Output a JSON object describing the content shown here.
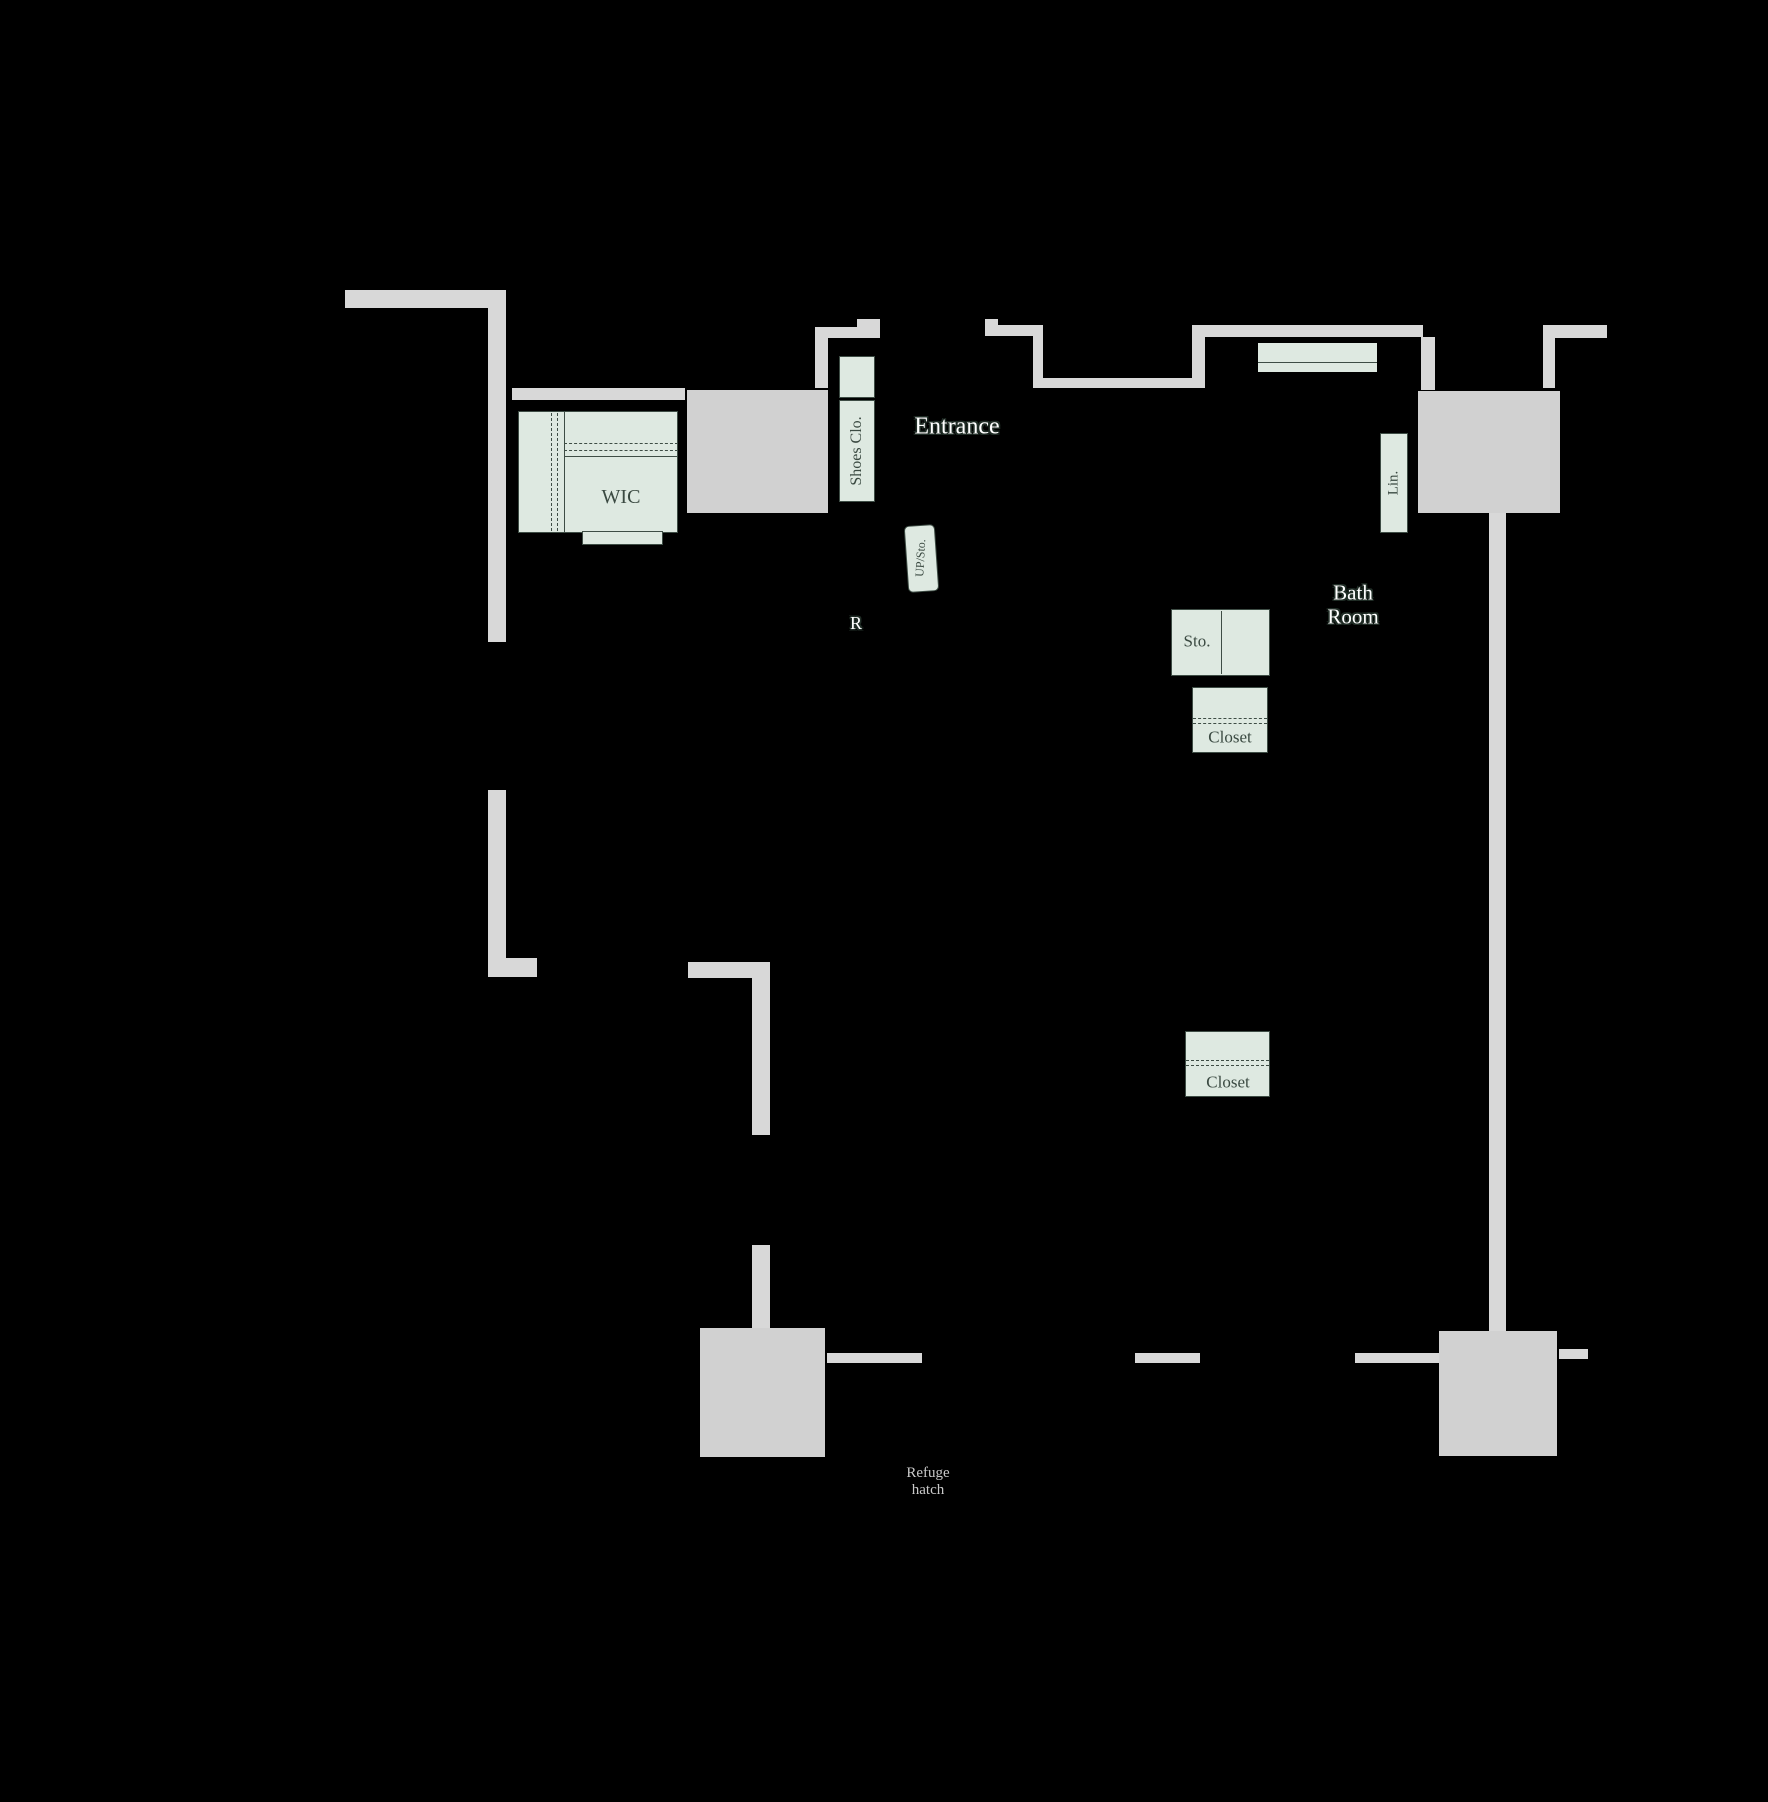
{
  "canvas": {
    "width": 1768,
    "height": 1802,
    "background": "#000000"
  },
  "colors": {
    "background": "#000000",
    "wall": "#d8d8d8",
    "wall_box": "#d1d1d1",
    "fixture_fill": "#dee9e1",
    "fixture_border": "#3e4d45",
    "label_dark": "#3b4a42",
    "label_outline": "#202d26",
    "label_gray": "#c9c9c9"
  },
  "labels": [
    {
      "id": "entrance-label",
      "text": "Entrance",
      "x": 957,
      "y": 427,
      "size": 24,
      "style": "outlined",
      "rot": 0
    },
    {
      "id": "bath-room-label",
      "lines": [
        "Bath",
        "Room"
      ],
      "x": 1353,
      "y": 605,
      "size": 21,
      "style": "outlined",
      "rot": 0
    },
    {
      "id": "r-mark-label",
      "text": "R",
      "x": 856,
      "y": 623,
      "size": 18,
      "style": "outlined",
      "rot": 0
    },
    {
      "id": "wic-label",
      "text": "WIC",
      "x": 621,
      "y": 497,
      "size": 20,
      "style": "dark",
      "rot": 0
    },
    {
      "id": "shoes-closet-label",
      "text": "Shoes Clo.",
      "x": 857,
      "y": 451,
      "size": 16,
      "style": "dark",
      "rot": -90
    },
    {
      "id": "linen-label",
      "text": "Lin.",
      "x": 1394,
      "y": 483,
      "size": 15,
      "style": "dark",
      "rot": -90
    },
    {
      "id": "storage-label",
      "text": "Sto.",
      "x": 1197,
      "y": 641,
      "size": 17,
      "style": "dark",
      "rot": 0
    },
    {
      "id": "closet-1-label",
      "text": "Closet",
      "x": 1230,
      "y": 737,
      "size": 17,
      "style": "dark",
      "rot": 0
    },
    {
      "id": "closet-2-label",
      "text": "Closet",
      "x": 1228,
      "y": 1082,
      "size": 17,
      "style": "dark",
      "rot": 0
    },
    {
      "id": "up-storage-label",
      "text": "UP/Sto.",
      "x": 921,
      "y": 558,
      "size": 12,
      "style": "dark",
      "rot": -87
    },
    {
      "id": "refuge-hatch-label",
      "lines": [
        "Refuge",
        "hatch"
      ],
      "x": 928,
      "y": 1482,
      "size": 15,
      "style": "gray",
      "rot": 0
    }
  ],
  "walls": [
    {
      "id": "wall-top-left-h",
      "x": 345,
      "y": 290,
      "w": 161,
      "h": 18
    },
    {
      "id": "wall-left-upper",
      "x": 488,
      "y": 290,
      "w": 18,
      "h": 352
    },
    {
      "id": "wall-left-lower",
      "x": 488,
      "y": 790,
      "w": 18,
      "h": 172
    },
    {
      "id": "wall-left-foot",
      "x": 488,
      "y": 958,
      "w": 49,
      "h": 19
    },
    {
      "id": "wall-wic-top",
      "x": 512,
      "y": 388,
      "w": 173,
      "h": 12
    },
    {
      "id": "wall-mid-left-h",
      "x": 688,
      "y": 962,
      "w": 82,
      "h": 16
    },
    {
      "id": "wall-mid-left-v",
      "x": 752,
      "y": 978,
      "w": 18,
      "h": 157
    },
    {
      "id": "wall-mid-left-v2",
      "x": 752,
      "y": 1245,
      "w": 18,
      "h": 83
    },
    {
      "id": "pillar-bottom-left",
      "x": 700,
      "y": 1328,
      "w": 125,
      "h": 129,
      "box": true
    },
    {
      "id": "wall-bottom-left-bar",
      "x": 827,
      "y": 1353,
      "w": 95,
      "h": 10
    },
    {
      "id": "wall-entrance-left-h",
      "x": 815,
      "y": 327,
      "w": 65,
      "h": 11
    },
    {
      "id": "wall-entrance-left-jamb",
      "x": 857,
      "y": 319,
      "w": 23,
      "h": 8
    },
    {
      "id": "wall-entrance-left-v",
      "x": 815,
      "y": 338,
      "w": 13,
      "h": 50
    },
    {
      "id": "wall-entrance-right-h",
      "x": 985,
      "y": 325,
      "w": 58,
      "h": 11
    },
    {
      "id": "wall-entrance-right-jamb",
      "x": 985,
      "y": 319,
      "w": 13,
      "h": 8
    },
    {
      "id": "wall-niche-left-v",
      "x": 1033,
      "y": 336,
      "w": 10,
      "h": 42
    },
    {
      "id": "wall-niche-bottom",
      "x": 1033,
      "y": 378,
      "w": 159,
      "h": 10
    },
    {
      "id": "wall-niche-right-v",
      "x": 1192,
      "y": 325,
      "w": 13,
      "h": 63
    },
    {
      "id": "wall-top-center-h",
      "x": 1193,
      "y": 325,
      "w": 230,
      "h": 12
    },
    {
      "id": "wall-top-center-v",
      "x": 1421,
      "y": 337,
      "w": 14,
      "h": 53
    },
    {
      "id": "wall-top-right-v",
      "x": 1543,
      "y": 325,
      "w": 12,
      "h": 63
    },
    {
      "id": "wall-top-right-h",
      "x": 1543,
      "y": 325,
      "w": 64,
      "h": 13
    },
    {
      "id": "pillar-top-right",
      "x": 1418,
      "y": 391,
      "w": 142,
      "h": 122,
      "box": true
    },
    {
      "id": "wall-right",
      "x": 1489,
      "y": 513,
      "w": 17,
      "h": 818
    },
    {
      "id": "pillar-bottom-right",
      "x": 1439,
      "y": 1331,
      "w": 118,
      "h": 125,
      "box": true
    },
    {
      "id": "wall-bottom-stub-1",
      "x": 1135,
      "y": 1353,
      "w": 65,
      "h": 10
    },
    {
      "id": "wall-bottom-stub-2",
      "x": 1355,
      "y": 1353,
      "w": 84,
      "h": 10
    },
    {
      "id": "wall-bottom-stub-3",
      "x": 1559,
      "y": 1349,
      "w": 29,
      "h": 10
    },
    {
      "id": "pillar-elevator",
      "x": 687,
      "y": 390,
      "w": 141,
      "h": 123,
      "box": true
    }
  ],
  "fixtures": [
    {
      "id": "wic-room",
      "x": 518,
      "y": 411,
      "w": 160,
      "h": 122
    },
    {
      "id": "wic-tab",
      "x": 582,
      "y": 531,
      "w": 81,
      "h": 14
    },
    {
      "id": "shoes-closet-upper",
      "x": 839,
      "y": 356,
      "w": 36,
      "h": 42
    },
    {
      "id": "shoes-closet",
      "x": 839,
      "y": 400,
      "w": 36,
      "h": 102
    },
    {
      "id": "bath-deck",
      "x": 1258,
      "y": 343,
      "w": 119,
      "h": 29,
      "noborder": true
    },
    {
      "id": "linen-closet",
      "x": 1380,
      "y": 433,
      "w": 28,
      "h": 100
    },
    {
      "id": "storage-box",
      "x": 1171,
      "y": 609,
      "w": 99,
      "h": 67
    },
    {
      "id": "closet-box-1",
      "x": 1192,
      "y": 687,
      "w": 76,
      "h": 66
    },
    {
      "id": "closet-box-2",
      "x": 1185,
      "y": 1031,
      "w": 85,
      "h": 66
    },
    {
      "id": "up-storage-stamp",
      "x": 906,
      "y": 525,
      "w": 31,
      "h": 67,
      "stamp": true
    }
  ],
  "detail_lines": [
    {
      "id": "wic-hanger-dash-1",
      "x": 551,
      "y": 413,
      "len": 118,
      "v": true,
      "dashed": true
    },
    {
      "id": "wic-hanger-dash-2",
      "x": 557,
      "y": 413,
      "len": 118,
      "v": true,
      "dashed": true
    },
    {
      "id": "wic-partition-v",
      "x": 564,
      "y": 411,
      "len": 122,
      "v": true,
      "dashed": false
    },
    {
      "id": "wic-shelf-dash-1",
      "x": 564,
      "y": 443,
      "len": 114,
      "v": false,
      "dashed": true
    },
    {
      "id": "wic-shelf-dash-2",
      "x": 564,
      "y": 450,
      "len": 114,
      "v": false,
      "dashed": true
    },
    {
      "id": "wic-shelf-solid",
      "x": 564,
      "y": 456,
      "len": 114,
      "v": false,
      "dashed": false
    },
    {
      "id": "storage-divider",
      "x": 1221,
      "y": 611,
      "len": 63,
      "v": true,
      "dashed": false
    },
    {
      "id": "closet-1-dash-1",
      "x": 1193,
      "y": 718,
      "len": 74,
      "v": false,
      "dashed": true
    },
    {
      "id": "closet-1-dash-2",
      "x": 1193,
      "y": 723,
      "len": 74,
      "v": false,
      "dashed": true
    },
    {
      "id": "closet-2-dash-1",
      "x": 1186,
      "y": 1060,
      "len": 83,
      "v": false,
      "dashed": true
    },
    {
      "id": "closet-2-dash-2",
      "x": 1186,
      "y": 1065,
      "len": 83,
      "v": false,
      "dashed": true
    },
    {
      "id": "bath-deck-edge",
      "x": 1258,
      "y": 362,
      "len": 119,
      "v": false,
      "dashed": false
    }
  ],
  "bathtub": {
    "outer": {
      "x": 1282,
      "y": 348,
      "w": 71,
      "h": 15
    },
    "inner": {
      "x": 1290,
      "y": 351,
      "w": 58,
      "h": 10
    },
    "ticks": {
      "x": 1259,
      "y": 366,
      "w": 117,
      "h": 6
    }
  }
}
